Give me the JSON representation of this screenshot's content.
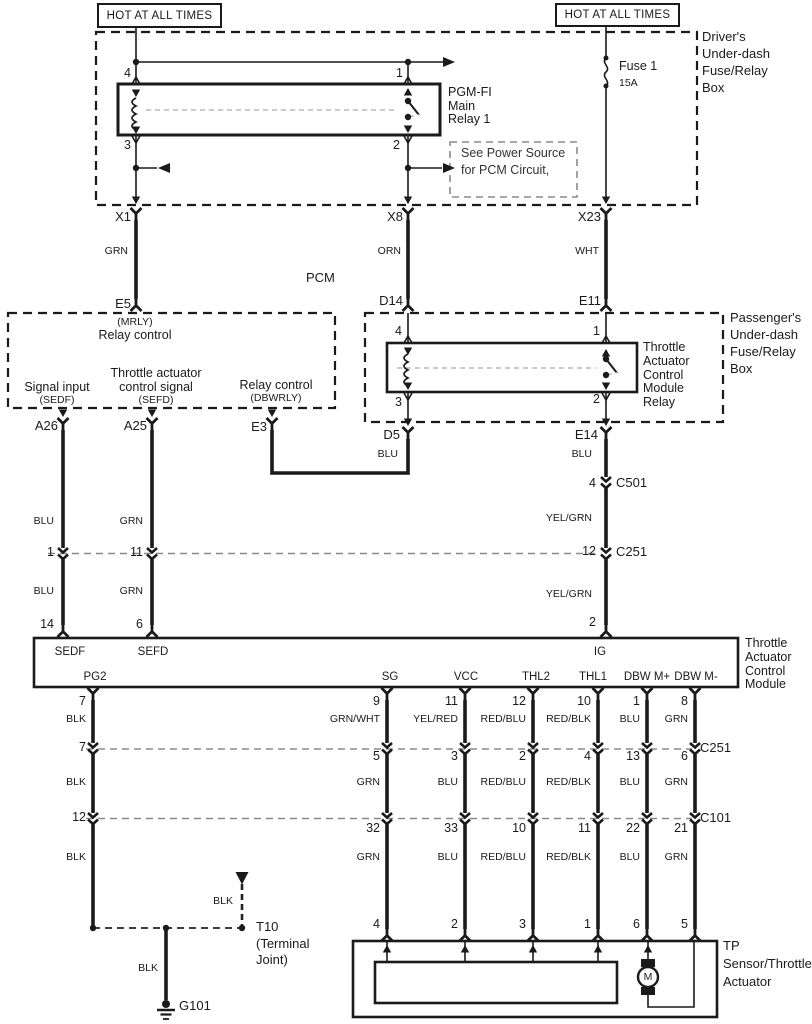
{
  "power": {
    "hot_left": "HOT AT ALL TIMES",
    "hot_right": "HOT AT ALL TIMES",
    "fuse_name": "Fuse 1",
    "fuse_rating": "15A"
  },
  "driver_box": {
    "line1": "Driver's",
    "line2": "Under-dash",
    "line3": "Fuse/Relay",
    "line4": "Box"
  },
  "pgm_relay": {
    "line1": "PGM-FI",
    "line2": "Main",
    "line3": "Relay 1",
    "pin4": "4",
    "pin1": "1",
    "pin3": "3",
    "pin2": "2"
  },
  "note": {
    "line1": "See Power Source",
    "line2": "for PCM Circuit,"
  },
  "grid_top": {
    "x1": "X1",
    "x8": "X8",
    "x23": "X23",
    "grn": "GRN",
    "orn": "ORN",
    "wht": "WHT",
    "e5": "E5",
    "d14": "D14",
    "e11": "E11"
  },
  "pcm": {
    "title": "PCM",
    "mrly": "(MRLY)",
    "relay_control": "Relay control",
    "signal_input": "Signal input",
    "sedf": "(SEDF)",
    "throttle_actuator": "Throttle actuator",
    "control_signal": "control signal",
    "sefd": "(SEFD)",
    "relay_control2": "Relay control",
    "dbwrly": "(DBWRLY)",
    "a26": "A26",
    "a25": "A25",
    "e3": "E3"
  },
  "passenger_box": {
    "line1": "Passenger's",
    "line2": "Under-dash",
    "line3": "Fuse/Relay",
    "line4": "Box"
  },
  "tac_relay": {
    "line1": "Throttle",
    "line2": "Actuator",
    "line3": "Control",
    "line4": "Module",
    "line5": "Relay",
    "pin4": "4",
    "pin1": "1",
    "pin3": "3",
    "pin2": "2"
  },
  "mid": {
    "d5": "D5",
    "d5_color": "BLU",
    "e14": "E14",
    "e14_color": "BLU",
    "c501_pin": "4",
    "c501": "C501",
    "yelgrn_1": "YEL/GRN",
    "c251_pin": "12",
    "c251": "C251",
    "yelgrn_2": "YEL/GRN",
    "ig_pin": "2",
    "a26_color1": "BLU",
    "a26_c251": "1",
    "a26_color2": "BLU",
    "a26_pin": "14",
    "a25_color1": "GRN",
    "a25_c251": "11",
    "a25_color2": "GRN",
    "a25_pin": "6"
  },
  "module": {
    "line1": "Throttle",
    "line2": "Actuator",
    "line3": "Control",
    "line4": "Module",
    "sedf": "SEDF",
    "sefd": "SEFD",
    "ig": "IG",
    "pg2": "PG2",
    "sg": "SG",
    "vcc": "VCC",
    "thl2": "THL2",
    "thl1": "THL1",
    "dbw_mp": "DBW M+",
    "dbw_mm": "DBW M-"
  },
  "matrix": {
    "c251": "C251",
    "c101": "C101",
    "columns": [
      {
        "pin": "7",
        "color1": "BLK",
        "c251": "7",
        "color2": "BLK",
        "c101": "12",
        "color3": "BLK",
        "tp": ""
      },
      {
        "pin": "9",
        "color1": "GRN/WHT",
        "c251": "5",
        "color2": "GRN",
        "c101": "32",
        "color3": "GRN",
        "tp": "4"
      },
      {
        "pin": "11",
        "color1": "YEL/RED",
        "c251": "3",
        "color2": "BLU",
        "c101": "33",
        "color3": "BLU",
        "tp": "2"
      },
      {
        "pin": "12",
        "color1": "RED/BLU",
        "c251": "2",
        "color2": "RED/BLU",
        "c101": "10",
        "color3": "RED/BLU",
        "tp": "3"
      },
      {
        "pin": "10",
        "color1": "RED/BLK",
        "c251": "4",
        "color2": "RED/BLK",
        "c101": "11",
        "color3": "RED/BLK",
        "tp": "1"
      },
      {
        "pin": "1",
        "color1": "BLU",
        "c251": "13",
        "color2": "BLU",
        "c101": "22",
        "color3": "BLU",
        "tp": "6"
      },
      {
        "pin": "8",
        "color1": "GRN",
        "c251": "6",
        "color2": "GRN",
        "c101": "21",
        "color3": "GRN",
        "tp": "5"
      }
    ]
  },
  "ground": {
    "stub_color": "BLK",
    "t10": "T10",
    "terminal": "(Terminal",
    "joint": "Joint)",
    "wire_color": "BLK",
    "g101": "G101"
  },
  "tp": {
    "line1": "TP",
    "line2": "Sensor/Throttle",
    "line3": "Actuator",
    "motor": "M"
  }
}
